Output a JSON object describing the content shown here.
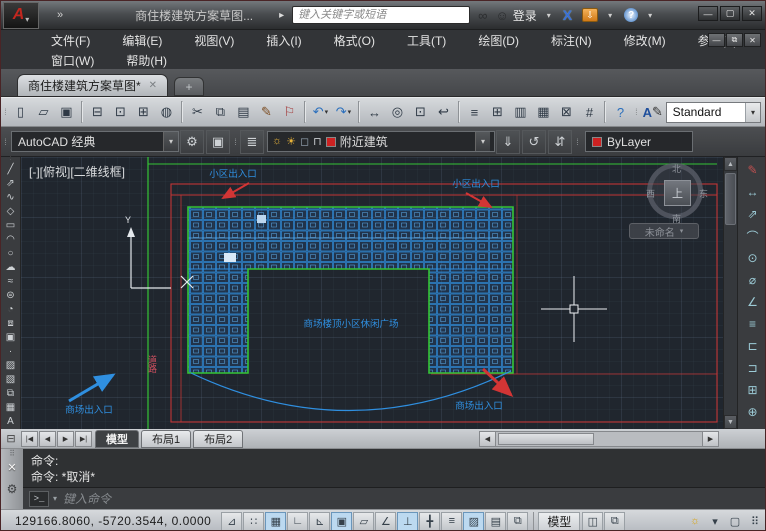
{
  "titlebar": {
    "app_title": "商住楼建筑方案草图...",
    "search_placeholder": "键入关键字或短语",
    "signin": "登录"
  },
  "icons": {
    "logo_letter": "A",
    "caret": "▾",
    "overflow": "»",
    "flyout": "▸",
    "binoculars": "∞",
    "user": "☺",
    "a360": "X",
    "exchange": "⇩",
    "help": "?",
    "minimize": "—",
    "restore": "▢",
    "close": "✕",
    "doc_minimize": "—",
    "doc_restore": "⧉",
    "doc_close": "✕",
    "tab_close": "✕",
    "tab_new": "+",
    "gear": "⚙",
    "workspace_settings": "▣",
    "layer_properties": "≣",
    "make_current": "⇓",
    "layer_match": "↺",
    "layer_previous": "⇵",
    "scroll_up": "▲",
    "scroll_down": "▼",
    "scroll_left": "◀",
    "scroll_right": "▶",
    "nav_first": "|◀",
    "nav_prev": "◀",
    "nav_next": "▶",
    "nav_last": "▶|",
    "annotation_monitor": "⊟",
    "cmd_grip": "⠿",
    "cmd_close": "✕",
    "cmd_wrench": "⚙",
    "cmd_prompt": ">_",
    "style_letter": "A"
  },
  "menubar": {
    "row1": [
      {
        "t": "文件(F)",
        "n": "menu-file"
      },
      {
        "t": "编辑(E)",
        "n": "menu-edit"
      },
      {
        "t": "视图(V)",
        "n": "menu-view"
      },
      {
        "t": "插入(I)",
        "n": "menu-insert"
      },
      {
        "t": "格式(O)",
        "n": "menu-format"
      },
      {
        "t": "工具(T)",
        "n": "menu-tools"
      },
      {
        "t": "绘图(D)",
        "n": "menu-draw"
      },
      {
        "t": "标注(N)",
        "n": "menu-dimension"
      },
      {
        "t": "修改(M)",
        "n": "menu-modify"
      },
      {
        "t": "参数(P)",
        "n": "menu-parametric"
      }
    ],
    "row2": [
      {
        "t": "窗口(W)",
        "n": "menu-window"
      },
      {
        "t": "帮助(H)",
        "n": "menu-help"
      }
    ]
  },
  "doc_tab": {
    "label": "商住楼建筑方案草图*"
  },
  "toolbar_standard": {
    "text_style_value": "Standard",
    "items": [
      {
        "n": "new-button",
        "g": "▯"
      },
      {
        "n": "open-button",
        "g": "▱"
      },
      {
        "n": "save-button",
        "g": "▣"
      },
      {
        "sep": true
      },
      {
        "n": "plot-button",
        "g": "⊟"
      },
      {
        "n": "plot-preview-button",
        "g": "⊡"
      },
      {
        "n": "publish-button",
        "g": "⊞"
      },
      {
        "n": "3d-dwf-button",
        "g": "◍"
      },
      {
        "sep": true
      },
      {
        "n": "cut-button",
        "g": "✂"
      },
      {
        "n": "copy-button",
        "g": "⧉"
      },
      {
        "n": "paste-button",
        "g": "▤"
      },
      {
        "n": "match-properties-button",
        "g": "✎",
        "c": "#7a4a1f"
      },
      {
        "n": "markup-button",
        "g": "⚐",
        "c": "#a33636"
      },
      {
        "sep": true
      },
      {
        "n": "undo-button",
        "g": "↶",
        "c": "#2a6fbd",
        "caret": true
      },
      {
        "n": "redo-button",
        "g": "↷",
        "c": "#2a6fbd",
        "caret": true
      },
      {
        "sep": true
      },
      {
        "n": "pan-button",
        "g": "↔"
      },
      {
        "n": "zoom-realtime-button",
        "g": "◎"
      },
      {
        "n": "zoom-window-button",
        "g": "⊡"
      },
      {
        "n": "zoom-previous-button",
        "g": "↩"
      },
      {
        "sep": true
      },
      {
        "n": "properties-button",
        "g": "≡"
      },
      {
        "n": "designcenter-button",
        "g": "⊞"
      },
      {
        "n": "tool-palettes-button",
        "g": "▥"
      },
      {
        "n": "sheet-set-manager-button",
        "g": "▦"
      },
      {
        "n": "markup-set-manager-button",
        "g": "⊠"
      },
      {
        "n": "quickcalc-button",
        "g": "#"
      },
      {
        "sep": true
      },
      {
        "n": "help-button",
        "g": "?",
        "c": "#2a6fbd"
      }
    ]
  },
  "toolbar_layers": {
    "workspace_value": "AutoCAD 经典",
    "layer_value": "附近建筑",
    "color_value": "ByLayer",
    "layer_color": "#cc2222",
    "state_icons": [
      {
        "n": "layer-on-icon",
        "g": "☼",
        "c": "#e8b33a"
      },
      {
        "n": "layer-freeze-icon",
        "g": "☀",
        "c": "#e8b33a"
      },
      {
        "n": "layer-plot-icon",
        "g": "◻",
        "c": "#9aaab8"
      },
      {
        "n": "layer-lock-icon",
        "g": "⊓",
        "c": "#c9cdd1"
      }
    ]
  },
  "viewport": {
    "label": "[-][俯视][二维线框]"
  },
  "viewcube": {
    "north": "北",
    "south": "南",
    "west": "西",
    "east": "东",
    "top": "上",
    "view_pill": "未命名"
  },
  "canvas_labels": {
    "entrance_top_left": "小区出入口",
    "entrance_top_right": "小区出入口",
    "plaza": "商场楼顶小区休闲广场",
    "mall_exit_left": "商场出入口",
    "mall_exit_right": "商场出入口",
    "road": "道路",
    "ucs_x": "X",
    "ucs_y": "Y"
  },
  "colors": {
    "boundary_red": "#c23535",
    "building_blue": "#2f8fe0",
    "outline_green": "#35c435"
  },
  "draw_toolbar": {
    "items": [
      {
        "n": "line-tool",
        "g": "╱"
      },
      {
        "n": "construction-line-tool",
        "g": "⇗"
      },
      {
        "n": "polyline-tool",
        "g": "∿"
      },
      {
        "n": "polygon-tool",
        "g": "◇"
      },
      {
        "n": "rectangle-tool",
        "g": "▭"
      },
      {
        "n": "arc-tool",
        "g": "◠"
      },
      {
        "n": "circle-tool",
        "g": "○"
      },
      {
        "n": "revision-cloud-tool",
        "g": "☁"
      },
      {
        "n": "spline-tool",
        "g": "≈"
      },
      {
        "n": "ellipse-tool",
        "g": "⊜"
      },
      {
        "n": "ellipse-arc-tool",
        "g": "◔"
      },
      {
        "n": "insert-block-tool",
        "g": "⧈"
      },
      {
        "n": "make-block-tool",
        "g": "▣"
      },
      {
        "n": "point-tool",
        "g": "·"
      },
      {
        "n": "hatch-tool",
        "g": "▨"
      },
      {
        "n": "gradient-tool",
        "g": "▧"
      },
      {
        "n": "region-tool",
        "g": "⧉"
      },
      {
        "n": "table-tool",
        "g": "▦"
      },
      {
        "n": "mtext-tool",
        "g": "A"
      }
    ]
  },
  "dim_toolbar": {
    "items": [
      {
        "n": "multileader-button",
        "g": "✎",
        "c": "#c05050"
      },
      {
        "n": "linear-dimension-button",
        "g": "↔"
      },
      {
        "n": "aligned-dimension-button",
        "g": "⇗"
      },
      {
        "n": "arc-length-button",
        "g": "⌒"
      },
      {
        "n": "radius-button",
        "g": "⊙"
      },
      {
        "n": "diameter-button",
        "g": "⌀"
      },
      {
        "n": "angular-button",
        "g": "∠"
      },
      {
        "n": "quick-dimension-button",
        "g": "≡"
      },
      {
        "n": "baseline-button",
        "g": "⊏"
      },
      {
        "n": "continue-button",
        "g": "⊐"
      },
      {
        "n": "tolerance-button",
        "g": "⊞"
      },
      {
        "n": "center-mark-button",
        "g": "⊕"
      }
    ]
  },
  "layout_tabs": {
    "model": "模型",
    "layout1": "布局1",
    "layout2": "布局2"
  },
  "command": {
    "line1": "命令:",
    "line2": "命令: *取消*",
    "input_placeholder": "键入命令"
  },
  "statusbar": {
    "coords": "129166.8060, -5720.3544, 0.0000",
    "model_button": "模型",
    "toggles": [
      {
        "n": "infer-constraints-toggle",
        "g": "⊿"
      },
      {
        "n": "snap-mode-toggle",
        "g": "∷"
      },
      {
        "n": "grid-display-toggle",
        "g": "▦",
        "on": true
      },
      {
        "n": "ortho-mode-toggle",
        "g": "∟"
      },
      {
        "n": "polar-tracking-toggle",
        "g": "⊾"
      },
      {
        "n": "object-snap-toggle",
        "g": "▣",
        "on": true
      },
      {
        "n": "3d-object-snap-toggle",
        "g": "▱"
      },
      {
        "n": "object-snap-tracking-toggle",
        "g": "∠"
      },
      {
        "n": "dynamic-ucs-toggle",
        "g": "⊥",
        "on": true
      },
      {
        "n": "dynamic-input-toggle",
        "g": "╋"
      },
      {
        "n": "lineweight-toggle",
        "g": "≡"
      },
      {
        "n": "transparency-toggle",
        "g": "▨",
        "on": true
      },
      {
        "n": "quick-properties-toggle",
        "g": "▤"
      },
      {
        "n": "selection-cycling-toggle",
        "g": "⧉"
      }
    ],
    "quickview": [
      {
        "n": "quick-view-layouts-button",
        "g": "◫"
      },
      {
        "n": "quick-view-drawings-button",
        "g": "⧉"
      }
    ],
    "right_icons": [
      {
        "n": "annotation-visibility-button",
        "g": "☼",
        "c": "#d9a514"
      },
      {
        "n": "chevron-down-icon",
        "g": "▾"
      },
      {
        "n": "clean-screen-button",
        "g": "▢"
      },
      {
        "n": "statusbar-grip",
        "g": "⠿"
      }
    ]
  }
}
